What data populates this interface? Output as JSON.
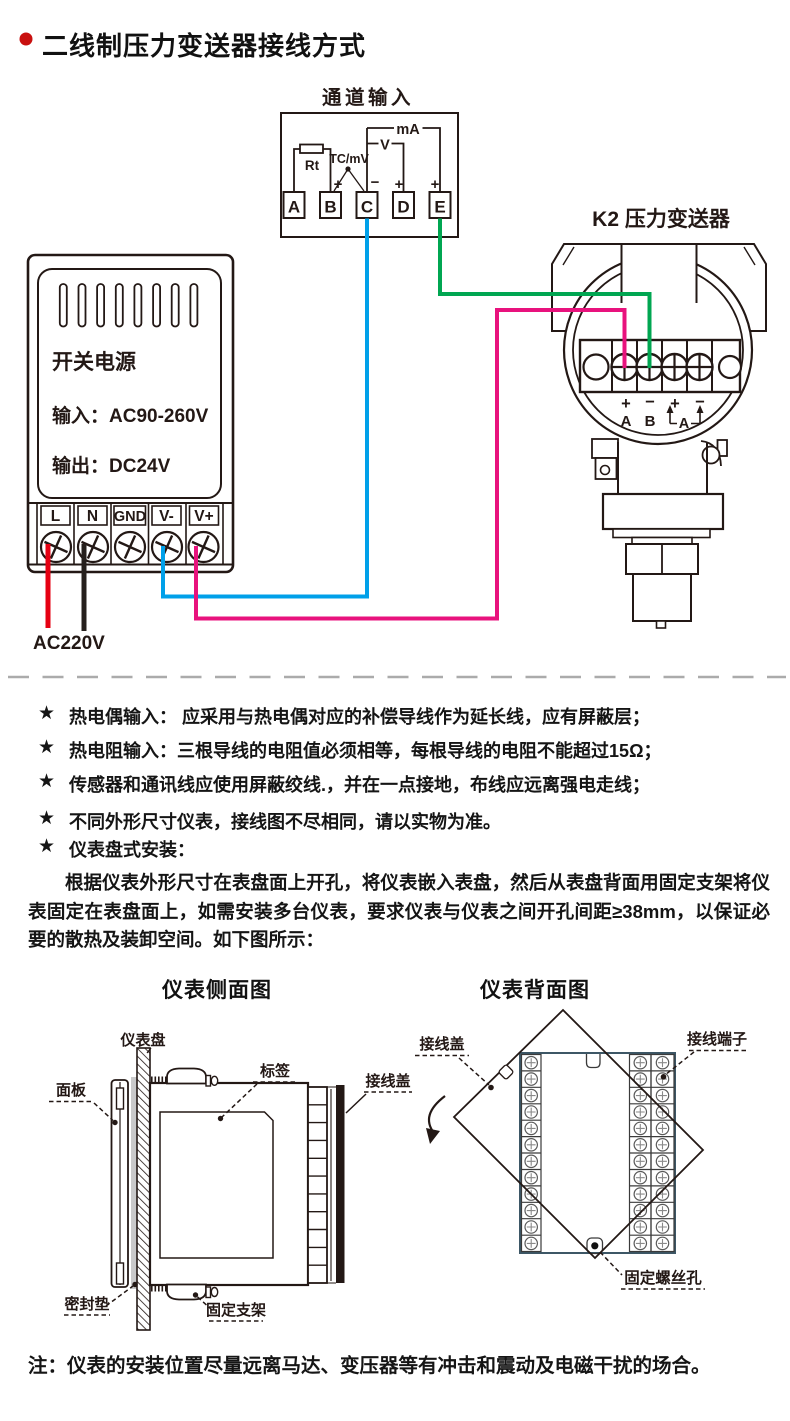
{
  "page": {
    "title": "二线制压力变送器接线方式",
    "bullet_color": "#c9100f"
  },
  "wiring": {
    "channel_input": {
      "title": "通道输入",
      "terminals": [
        "A",
        "B",
        "C",
        "D",
        "E"
      ],
      "rt_label": "Rt",
      "tc_label": "TC/mV",
      "v_label": "V",
      "ma_label": "mA",
      "sign_b": "+",
      "sign_c": "−",
      "sign_d": "+",
      "sign_e": "+"
    },
    "psu": {
      "name": "开关电源",
      "input_label": "输入：AC90-260V",
      "output_label": "输出：DC24V",
      "terminals": [
        "L",
        "N",
        "GND",
        "V-",
        "V+"
      ],
      "mains_label": "AC220V"
    },
    "transmitter": {
      "title": "K2 压力变送器",
      "term_signs": [
        "+",
        "−",
        "+",
        "−"
      ],
      "term_letters": [
        "A",
        "B"
      ],
      "loop_label": "A"
    },
    "wire_colors": {
      "live_red": "#e60012",
      "neutral_black": "#26201d",
      "signal_blue": "#00a0e9",
      "supply_pink": "#e8127d",
      "return_green": "#00a651"
    }
  },
  "notes": {
    "star": "★",
    "items": [
      "热电偶输入： 应采用与热电偶对应的补偿导线作为延长线，应有屏蔽层；",
      "热电阻输入：三根导线的电阻值必须相等，每根导线的电阻不能超过15Ω；",
      "传感器和通讯线应使用屏蔽绞线.，并在一点接地，布线应远离强电走线；",
      "不同外形尺寸仪表，接线图不尽相同，请以实物为准。",
      "仪表盘式安装："
    ]
  },
  "install": {
    "intro": "根据仪表外形尺寸在表盘面上开孔，将仪表嵌入表盘，然后从表盘背面用固定支架将仪表固定在表盘面上，如需安装多台仪表，要求仪表与仪表之间开孔间距≥38mm，以保证必要的散热及装卸空间。如下图所示：",
    "side_view": {
      "title": "仪表侧面图",
      "labels": {
        "panel_board": "仪表盘",
        "front_panel": "面板",
        "label_tag": "标签",
        "terminal_cover": "接线盖",
        "gasket": "密封垫",
        "bracket": "固定支架"
      }
    },
    "back_view": {
      "title": "仪表背面图",
      "labels": {
        "terminal_cover": "接线盖",
        "terminals": "接线端子",
        "screw_hole": "固定螺丝孔"
      }
    }
  },
  "footer": {
    "note": "注：仪表的安装位置尽量远离马达、变压器等有冲击和震动及电磁干扰的场合。"
  }
}
